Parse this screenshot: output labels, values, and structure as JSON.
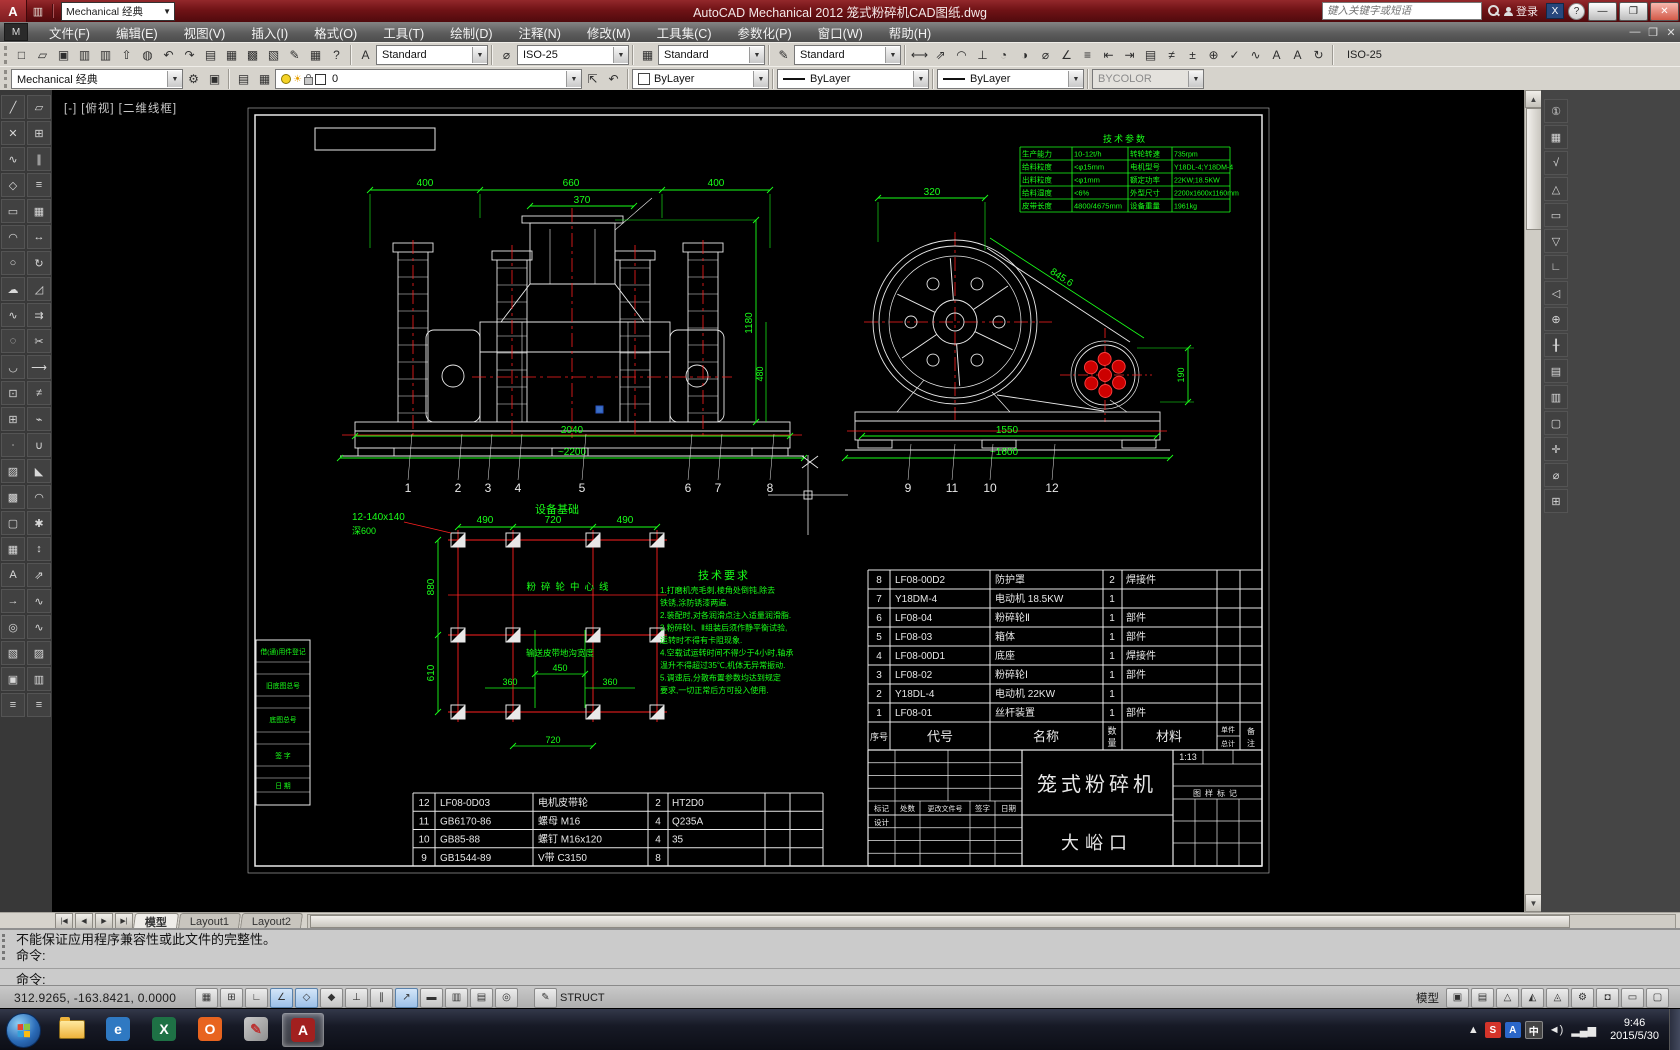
{
  "titlebar": {
    "app_title": "AutoCAD Mechanical 2012    笼式粉碎机CAD图纸.dwg",
    "workspace": "Mechanical 经典",
    "search_placeholder": "键入关键字或短语",
    "signin_label": "登录",
    "qat_icons": [
      "new",
      "open",
      "save",
      "save-as",
      "plot",
      "undo",
      "undo-arrow",
      "redo",
      "workspace-switch"
    ]
  },
  "menubar": {
    "items": [
      "文件(F)",
      "编辑(E)",
      "视图(V)",
      "插入(I)",
      "格式(O)",
      "工具(T)",
      "绘制(D)",
      "注释(N)",
      "修改(M)",
      "工具集(C)",
      "参数化(P)",
      "窗口(W)",
      "帮助(H)"
    ]
  },
  "toolbar1": {
    "std_icons": [
      "new-drawing",
      "open",
      "save",
      "plot",
      "plot-preview",
      "publish",
      "etransmit",
      "undo",
      "redo",
      "properties-palette",
      "design-center",
      "tool-palettes",
      "sheet-set-manager",
      "markup-set-manager",
      "quickcalc",
      "help"
    ],
    "text_style": "Standard",
    "dim_style": "ISO-25",
    "table_style": "Standard",
    "mleader_style": "Standard",
    "dim_icons": [
      "linear-dimension",
      "aligned-dimension",
      "arc-length",
      "ordinate",
      "radius",
      "jogged",
      "diameter",
      "angular",
      "quick-dimension",
      "baseline-dimension",
      "continue-dimension",
      "dimension-space",
      "dimension-break",
      "tolerance",
      "center-mark",
      "inspection",
      "jogged-linear",
      "dimension-edit",
      "dimension-text-edit",
      "dimension-update"
    ],
    "dim_current": "ISO-25"
  },
  "toolbar2": {
    "workspace": "Mechanical 经典",
    "ws_icons": [
      "workspace-settings",
      "workspace-save"
    ],
    "layer_icons": [
      "layer-properties-manager",
      "layer-states"
    ],
    "layer": "0",
    "post_layer_icons": [
      "make-object-layer-current",
      "layer-previous"
    ],
    "color": "ByLayer",
    "linetype": "ByLayer",
    "lineweight": "ByLayer",
    "plot_style": "BYCOLOR"
  },
  "left_toolbar": {
    "draw": [
      "line",
      "construction-line",
      "polyline",
      "polygon",
      "rectangle",
      "arc",
      "circle",
      "revision-cloud",
      "spline",
      "ellipse",
      "ellipse-arc",
      "insert-block",
      "make-block",
      "point",
      "hatch",
      "gradient",
      "region",
      "table",
      "multiline-text",
      "ray",
      "donut",
      "wipeout",
      "boundary",
      "divide"
    ],
    "modify": [
      "erase",
      "copy",
      "mirror",
      "offset",
      "array",
      "move",
      "rotate",
      "scale",
      "stretch",
      "trim",
      "extend",
      "break-at-point",
      "break",
      "join",
      "chamfer",
      "fillet",
      "explode",
      "lengthen",
      "align",
      "edit-polyline",
      "edit-spline",
      "edit-hatch",
      "match-properties",
      "measure"
    ]
  },
  "right_toolbar": {
    "icons": [
      "balloon",
      "parts-list",
      "surface-texture",
      "weld-symbol",
      "feature-control-frame",
      "datum-identifier",
      "edge-symbol",
      "taper-symbol",
      "centerline-cross",
      "centerline",
      "hole-chart",
      "fits-list",
      "title-border",
      "screw-connection",
      "shaft-generator",
      "standard-parts"
    ]
  },
  "viewport": {
    "controls": [
      "[-]",
      "[俯视]",
      "[二维线框]"
    ]
  },
  "tabs": {
    "nav": [
      "first",
      "prev",
      "next",
      "last"
    ],
    "model": "模型",
    "layout1": "Layout1",
    "layout2": "Layout2"
  },
  "command": {
    "history1": "不能保证应用程序兼容性或此文件的完整性。",
    "history2": "命令:",
    "prompt": "命令:"
  },
  "statusbar": {
    "coords": "312.9265, -163.8421, 0.0000",
    "toggles": [
      "snap-mode",
      "grid-display",
      "ortho-mode",
      "polar-tracking",
      "object-snap",
      "object-snap-3d",
      "object-snap-tracking",
      "dynamic-ucs",
      "dynamic-input",
      "lineweight-display",
      "transparency",
      "quick-properties",
      "selection-cycling"
    ],
    "toggles_on": [
      3,
      4,
      8
    ],
    "struct_label": "STRUCT",
    "model_toggle": "模型",
    "right_icons": [
      "quick-view-layouts",
      "quick-view-drawings",
      "annotation-scale",
      "annotation-visibility",
      "autoscale",
      "workspace-switching",
      "toolbar-lock",
      "performance",
      "clean-screen"
    ]
  },
  "taskbar": {
    "apps": [
      "explorer",
      "browser",
      "excel",
      "app-orange",
      "paint",
      "autocad"
    ],
    "active_app": "autocad",
    "tray_icons": [
      "hidden-icons",
      "sogou-input",
      "input-a",
      "ime-cn",
      "speaker",
      "network"
    ],
    "time": "9:46",
    "date": "2015/5/30"
  },
  "drawing": {
    "tech_params": {
      "title": "技术参数",
      "rows": [
        [
          "生产能力",
          "10-12t/h",
          "转轮转速",
          "735rpm"
        ],
        [
          "给料粒度",
          "<φ15mm",
          "电机型号",
          "Y18DL-4;Y18DM-4"
        ],
        [
          "出料粒度",
          "<φ1mm",
          "额定功率",
          "22KW;18.5KW"
        ],
        [
          "给料湿度",
          "<6%",
          "外型尺寸",
          "2200x1600x1160mm"
        ],
        [
          "皮带长度",
          "4800/4675mm",
          "设备重量",
          "1961kg"
        ]
      ]
    },
    "bom_upper": {
      "headers": {
        "no": "序号",
        "code": "代号",
        "name": "名称",
        "qty": "数量",
        "mat": "材料",
        "w1": "单件",
        "w2": "总计",
        "note": "备注"
      },
      "rows": [
        [
          "8",
          "LF08-00D2",
          "防护罩",
          "2",
          "焊接件"
        ],
        [
          "7",
          "Y18DM-4",
          "电动机  18.5KW",
          "1",
          ""
        ],
        [
          "6",
          "LF08-04",
          "粉碎轮Ⅱ",
          "1",
          "部件"
        ],
        [
          "5",
          "LF08-03",
          "箱体",
          "1",
          "部件"
        ],
        [
          "4",
          "LF08-00D1",
          "底座",
          "1",
          "焊接件"
        ],
        [
          "3",
          "LF08-02",
          "粉碎轮Ⅰ",
          "1",
          "部件"
        ],
        [
          "2",
          "Y18DL-4",
          "电动机  22KW",
          "1",
          ""
        ],
        [
          "1",
          "LF08-01",
          "丝杆装置",
          "1",
          "部件"
        ]
      ]
    },
    "bom_lower": {
      "rows": [
        [
          "12",
          "LF08-0D03",
          "电机皮带轮",
          "2",
          "HT2D0"
        ],
        [
          "11",
          "GB6170-86",
          "螺母  M16",
          "4",
          "Q235A"
        ],
        [
          "10",
          "GB85-88",
          "螺钉  M16x120",
          "4",
          "35"
        ],
        [
          "9",
          "GB1544-89",
          "V带  C3150",
          "8",
          ""
        ]
      ]
    },
    "title_block": {
      "product": "笼式粉碎机",
      "company": "大峪口",
      "scale": "1:13",
      "stage_label": "图样标记",
      "mark_row": [
        "标记",
        "处数",
        "更改文件号",
        "签字",
        "日期"
      ],
      "design_label": "设计"
    },
    "side_block": {
      "rows": [
        "借(通)用件登记",
        "旧底图总号",
        "底图总号",
        "签  字",
        "日  期"
      ]
    },
    "front_view": {
      "dims": {
        "d400a": "400",
        "d660": "660",
        "d400b": "400",
        "d370": "370",
        "d1180": "1180",
        "d480": "480",
        "d2040": "2040",
        "d2200": "~2200"
      },
      "balloons": [
        "1",
        "2",
        "3",
        "4",
        "5",
        "6",
        "7",
        "8"
      ]
    },
    "side_view": {
      "dims": {
        "d320": "320",
        "d845": "845.6",
        "d190": "190",
        "d1550": "1550",
        "d1600": "~1600"
      },
      "balloons": [
        "9",
        "11",
        "10",
        "12"
      ]
    },
    "foundation": {
      "title": "设备基础",
      "bolt_label": "12-140x140",
      "depth_label": "深600",
      "center_label": "粉碎轮中心线",
      "trench_label": "输送皮带地沟宽度",
      "dims": {
        "d490a": "490",
        "d720a": "720",
        "d490b": "490",
        "d880": "880",
        "d610": "610",
        "d450": "450",
        "d360a": "360",
        "d360b": "360",
        "d720b": "720"
      }
    },
    "tech_req": {
      "title": "技术要求",
      "lines": [
        "1.打磨机壳毛刺,棱角处倒钝,除去",
        "  铁锈,涂防锈漆两遍.",
        "2.装配时,对各润滑点注入适量润滑脂.",
        "3.粉碎轮Ⅰ、Ⅱ组装后须作静平衡试验,",
        "  运转时不得有卡阻现象.",
        "4.空载试运转时间不得少于4小时,轴承",
        "  温升不得超过35℃,机体无异常振动.",
        "5.调速后,分散布置参数均达到规定",
        "  要求,一切正常后方可投入使用."
      ]
    }
  }
}
